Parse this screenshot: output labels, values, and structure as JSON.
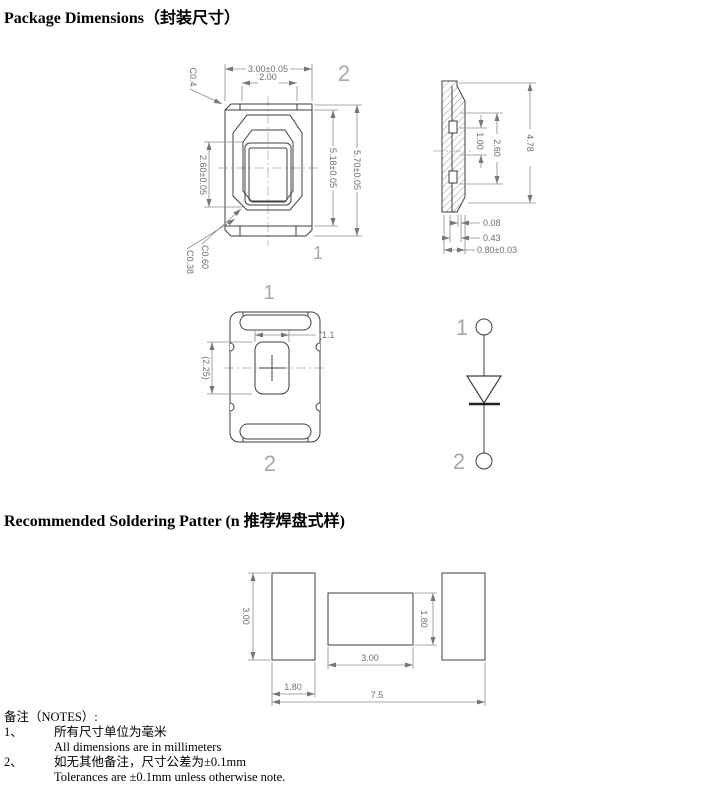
{
  "page": {
    "title": "Package Dimensions（封装尺寸）",
    "soldering_title": "Recommended Soldering Patter (n 推荐焊盘式样)"
  },
  "colors": {
    "outline": "#3f3f3f",
    "dimension": "#8c8c8c",
    "dim_text": "#6e6e6e",
    "marker": "#a8a8a8"
  },
  "figure": {
    "top_view": {
      "dim_overall_width": "3.00±0.05",
      "dim_window_width": "2.00",
      "chamfer_top_left": "C0.4",
      "dim_cavity_height": "2.60±0.05",
      "dim_inner_height": "5.18±0.05",
      "dim_overall_height": "5.70±0.05",
      "chamfer_bottom_1": "C0.60",
      "chamfer_bottom_2": "C0.38",
      "marker_pin2": "2",
      "marker_pin1": "1"
    },
    "side_view": {
      "dim_step": "1.00",
      "dim_cavity": "2.60",
      "dim_height": "4.78",
      "dim_standoff": "0.08",
      "dim_lead": "0.43",
      "dim_thickness": "0.80±0.03"
    },
    "bottom_view": {
      "marker_pin1": "1",
      "marker_pin2": "2",
      "dim_slot_width": "(1.1",
      "dim_slot_height": "(2.25)"
    },
    "schematic": {
      "pin1": "1",
      "pin2": "2"
    }
  },
  "solder": {
    "pad_height": "3.00",
    "pad_width": "1.80",
    "gap_width": "3.00",
    "gap_height": "1.80",
    "total_width": "7.5"
  },
  "notes": {
    "heading": "备注（NOTES）:",
    "items": [
      {
        "num": "1、",
        "zh": "所有尺寸单位为毫米",
        "en": "All dimensions are in millimeters"
      },
      {
        "num": "2、",
        "zh": "如无其他备注，尺寸公差为±0.1mm",
        "en": "Tolerances are ±0.1mm unless otherwise note."
      }
    ]
  }
}
